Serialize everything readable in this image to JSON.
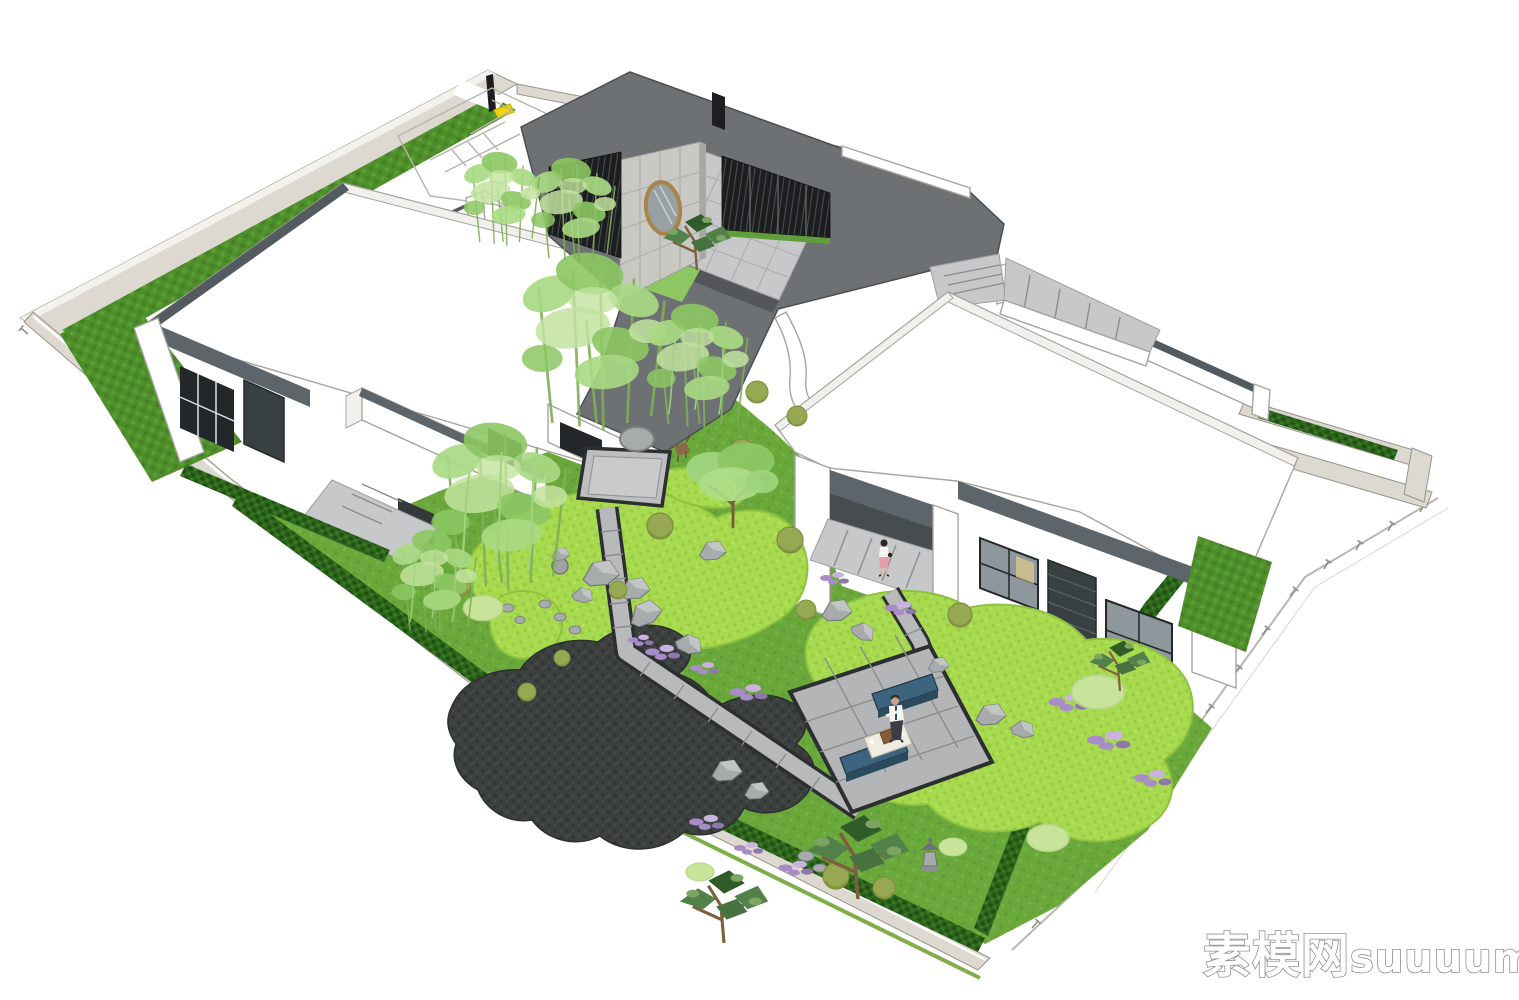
{
  "meta": {
    "description": "Aerial oblique 3D model rendering of a walled Chinese-style courtyard villa with landscaped garden",
    "render_style": "SketchUp-like architectural visualization on white background",
    "background": "#ffffff"
  },
  "watermark": {
    "cn": "素模网",
    "latin": "suuuum.com",
    "full": "素模网suuuum.com"
  },
  "palette": {
    "roof_dark": "#6d7173",
    "roof_edge": "#4b4f52",
    "white_roof": "#ffffff",
    "white_shadow": "#f1f0ec",
    "outline": "#a6a49e",
    "wall_light": "#ddd9d1",
    "wall_top": "#f4f2ec",
    "coping_dark": "#545b60",
    "fascia": "#5d646a",
    "concrete": "#c9c9c4",
    "screen_dark": "#1b1d1e",
    "pave": "#c6c8c9",
    "pave_shadow": "#53575a",
    "path_stone": "#b7b9ba",
    "path_border": "#2c2f30",
    "platform": "#bcbebf",
    "patio": "#b3b5b6",
    "lawn_bright": "#a8da50",
    "lawn_texture": "#97cb41",
    "lawn_strip": "#4f8f2b",
    "ground_mid": "#6aa83c",
    "hedge": "#2d661c",
    "pond": "#3c403f",
    "glass": "#8e989c",
    "window_frame": "#23272a",
    "louver": "#394042",
    "bench_blue": "#3c647f",
    "bench_side": "#2c4a5e",
    "table_top": "#efece2",
    "wood_box": "#8a5c36",
    "bamboo": "#a9d983",
    "bamboo_dark": "#8cc763",
    "willow": "#9ed47e",
    "pine": "#53814a",
    "pine_dark": "#2f5c28",
    "shrub": "#96a851",
    "mound": "#c8e49b",
    "purple": "#a88cc8",
    "rock": "#a8abac",
    "rock_shade": "#6f7374",
    "bronze_rim": "#a8834b",
    "moon_glass": "#99a0a2",
    "yellow_pad": "#f2d500",
    "figure_pink": "#e89cb0",
    "figure_white": "#f5f4f0",
    "verge_green": "#7fae4a",
    "fence_gray": "#8f8f89",
    "watermark_stroke": "#909090"
  },
  "scene": {
    "site": {
      "boundary": "walled rectangular plot viewed from above at an angle",
      "entry_gate": "north gate with black post and yellow pad",
      "perimeter_features": [
        "outer wall band",
        "lawn strips inside walls",
        "clipped hedges",
        "south survey fence ticks",
        "perimeter road"
      ]
    },
    "buildings": [
      {
        "id": "entry-pavilion",
        "label": "entry pavilion: dark gray roof, circular moon-gate window, black timber slat screens, paved inner courtyard, sloped walkway canopy"
      },
      {
        "id": "west-villa",
        "label": "west villa: white flat roof, dark fascia, gridded dark windows, garden porch"
      },
      {
        "id": "east-villa",
        "label": "east villa: white flat roof, dark fascia, covered porch with standing woman, glass walls and louver panel"
      }
    ],
    "garden_features": [
      "square stone platform",
      "round stepping pad",
      "L-shaped stone path",
      "bright lawn mounds",
      "dark gravel pond bed",
      "rock groupings",
      "stone lantern",
      "tea patio with two blue benches and tray table",
      "standing man figure",
      "bamboo and willow clumps",
      "pine trees",
      "purple flower drifts",
      "deer ornament"
    ]
  }
}
